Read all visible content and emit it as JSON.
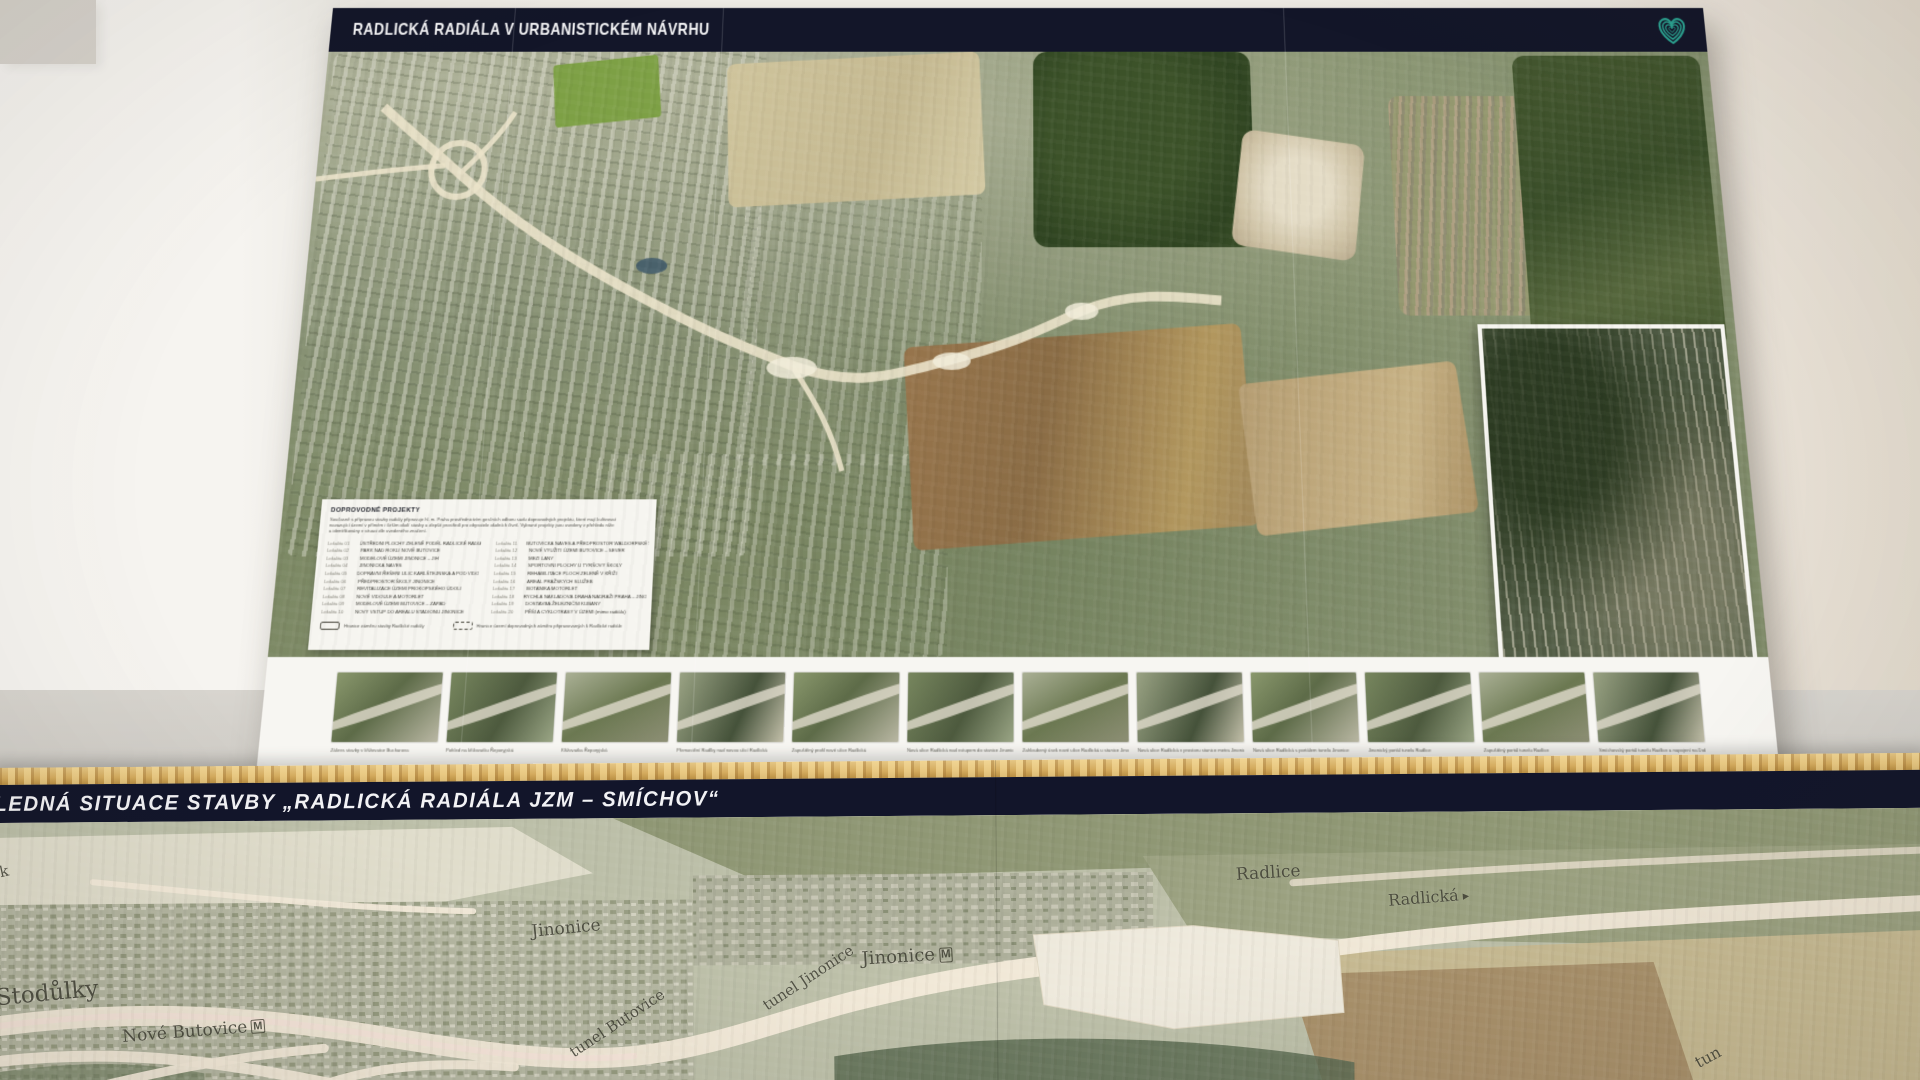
{
  "top_poster": {
    "title": "RADLICKÁ RADIÁLA V URBANISTICKÉM NÁVRHU",
    "logo_icon": "striped-heart-logo",
    "logo_color": "#2ba291",
    "bar_color": "#131629",
    "legend": {
      "heading": "DOPROVODNÉ PROJEKTY",
      "intro_lines": [
        "Současně s přípravou stavby radiály připravuje hl. m. Praha prostřednictvím gesčních odborů sadu doprovodných projektů, které mají kultivovat",
        "navazující území v přímém i širším okolí stavby a zlepšit prostředí pro obyvatele okolních čtvrtí. Vybrané projekty jsou uvedeny v přehledu níže",
        "a identifikovány v situaci dle uvedeného značení."
      ],
      "items_left": [
        {
          "code": "Lokalita 01",
          "label": "ÚSTŘEDNÍ PLOCHY ZELENĚ PODÉL RADLICKÉ RADIÁLY"
        },
        {
          "code": "Lokalita 02",
          "label": "PARK NAD ROKLÍ NOVÉ BUTOVICE"
        },
        {
          "code": "Lokalita 03",
          "label": "MODELOVÉ ÚZEMÍ JINONICE – JIH"
        },
        {
          "code": "Lokalita 04",
          "label": "JINONICKÁ NÁVES"
        },
        {
          "code": "Lokalita 05",
          "label": "DOPRAVNÍ ŘEŠENÍ ULIC KARLŠTEJNSKÁ A POD VIDOULÍ"
        },
        {
          "code": "Lokalita 06",
          "label": "PŘEDPROSTOR ŠKOLY JINONICE"
        },
        {
          "code": "Lokalita 07",
          "label": "REVITALIZACE ÚZEMÍ PROKOPSKÉHO ÚDOLÍ"
        },
        {
          "code": "Lokalita 08",
          "label": "NOVÉ VIDOULE A MOTORLET"
        },
        {
          "code": "Lokalita 09",
          "label": "MODELOVÉ ÚZEMÍ BUTOVICE – ZÁPAD"
        },
        {
          "code": "Lokalita 10",
          "label": "NOVÝ VSTUP DO AREÁLU STADIONU JINONICE"
        }
      ],
      "items_right": [
        {
          "code": "Lokalita 11",
          "label": "BUTOVICKÁ NÁVES A PŘEDPROSTOR WALDORFSKÉ ŠKOLY"
        },
        {
          "code": "Lokalita 12",
          "label": "NOVÉ VYUŽITÍ ÚZEMÍ BUTOVICE – SEVER"
        },
        {
          "code": "Lokalita 13",
          "label": "MEZI LÁNY"
        },
        {
          "code": "Lokalita 14",
          "label": "SPORTOVNÍ PLOCHY U TYRŠOVY ŠKOLY"
        },
        {
          "code": "Lokalita 15",
          "label": "REHABILITACE PLOCH ZELENĚ V KŘÍŽI"
        },
        {
          "code": "Lokalita 16",
          "label": "AREÁL PRAŽSKÝCH SLUŽEB"
        },
        {
          "code": "Lokalita 17",
          "label": "BOTANIKA MOTORLET"
        },
        {
          "code": "Lokalita 18",
          "label": "RYCHLÁ NÁKLADOVÁ DRÁHA NÁDRAŽÍ PRAHA – JINONICE"
        },
        {
          "code": "Lokalita 19",
          "label": "DOSTAVBA ŽELEZNIČNÍ KUBÁNY"
        },
        {
          "code": "Lokalita 20",
          "label": "PĚŠÍ A CYKLOTRASY V ÚZEMÍ (mimo radiálu)"
        }
      ],
      "footer_keys": [
        {
          "symbol": "solid-outline-box",
          "label": "Hranice záměru stavby Radlické radiály"
        },
        {
          "symbol": "dashed-outline-box",
          "label": "Hranice území doprovodných záměrů připravovaných k Radlické radiále"
        }
      ]
    },
    "thumbnails": [
      {
        "caption": "Zákres stavby v křižovatce Bucharova"
      },
      {
        "caption": "Pohled na křižovatku Řeporyjská"
      },
      {
        "caption": "Křižovatka Řeporyjská"
      },
      {
        "caption": "Přemostění Radlky nad novou ulicí Radlická"
      },
      {
        "caption": "Zapuštěný profil nové ulice Radlická"
      },
      {
        "caption": "Nová ulice Radlická nad vstupem do stanice Jinonice"
      },
      {
        "caption": "Zahloubený úsek nové ulice Radlická u stanice Jinonice"
      },
      {
        "caption": "Nová ulice Radlická v prostoru stanice metra Jinonice"
      },
      {
        "caption": "Nová ulice Radlická s portálem tunelu Jinonice"
      },
      {
        "caption": "Jinonický portál tunelu Radlice"
      },
      {
        "caption": "Zapuštěný portál tunelu Radlice"
      },
      {
        "caption": "Smíchovský portál tunelu Radlice a napojení na Dobříšskou"
      }
    ]
  },
  "bottom_poster": {
    "title_visible": "LEDNÁ SITUACE STAVBY „RADLICKÁ RADIÁLA JZM – SMÍCHOV“",
    "metro_badge_char": "M",
    "arrow_char": "▸",
    "map_labels": [
      {
        "text": "jk",
        "x": 2,
        "y": 40,
        "size": 15,
        "rot": -12
      },
      {
        "text": "Stodůlky",
        "x": 2,
        "y": 158,
        "size": 23,
        "rot": -5
      },
      {
        "text": "Nové Butovice",
        "x": 128,
        "y": 200,
        "size": 17,
        "rot": -4,
        "metro": true
      },
      {
        "text": "Jinonice",
        "x": 538,
        "y": 100,
        "size": 17,
        "rot": -5
      },
      {
        "text": "tunel Butovice",
        "x": 568,
        "y": 196,
        "size": 15,
        "rot": -33
      },
      {
        "text": "tunel Jinonice",
        "x": 762,
        "y": 152,
        "size": 15,
        "rot": -33
      },
      {
        "text": "Jinonice",
        "x": 868,
        "y": 130,
        "size": 18,
        "rot": -3,
        "metro": true
      },
      {
        "text": "Radlice",
        "x": 1243,
        "y": 50,
        "size": 17,
        "rot": -3
      },
      {
        "text": "Radlická",
        "x": 1395,
        "y": 76,
        "size": 16,
        "rot": -4,
        "arrow": true
      },
      {
        "text": "tun",
        "x": 1700,
        "y": 238,
        "size": 16,
        "rot": -28
      }
    ]
  },
  "colors": {
    "bar_navy": "#131629",
    "heart_teal": "#2ba291",
    "wood_edge": "#d4ab5e",
    "wall": "#ece8e1"
  }
}
